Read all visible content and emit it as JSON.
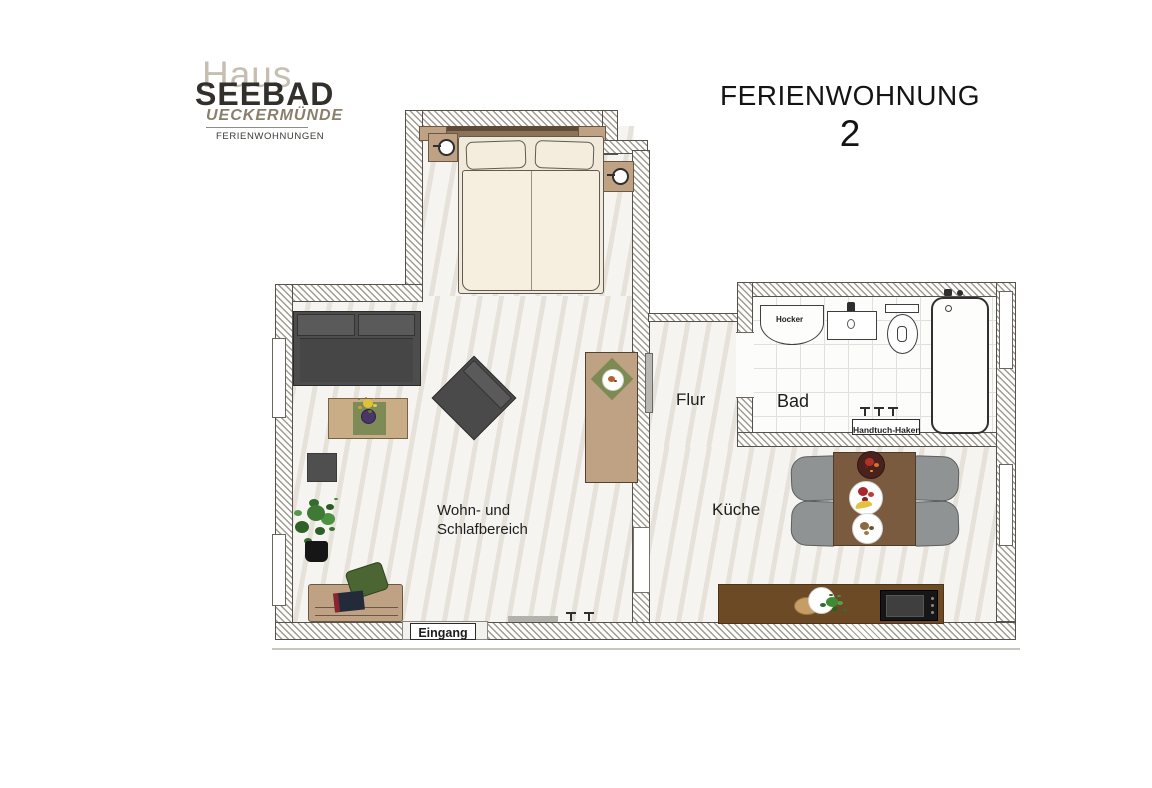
{
  "logo": {
    "line1": "Haus",
    "line2": "SEEBAD",
    "line3": "UECKERMÜNDE",
    "line4": "FERIENWOHNUNGEN"
  },
  "title": {
    "main": "FERIENWOHNUNG",
    "number": "2"
  },
  "rooms": {
    "living": {
      "line1": "Wohn- und",
      "line2": "Schlafbereich"
    },
    "hall": {
      "label": "Flur"
    },
    "bath": {
      "label": "Bad"
    },
    "kitchen": {
      "label": "Küche"
    },
    "entrance": {
      "label": "Eingang"
    }
  },
  "bath_items": {
    "stool_label": "Hocker",
    "towel_hooks_label": "Handtuch-Haken"
  },
  "palette": {
    "wall_line": "#56524b",
    "hatch": "#a19c93",
    "floor": "#edeae3",
    "bath_floor": "#fcfcfb",
    "tile_line": "#e2e0db",
    "bed": "#f6efe0",
    "outline": "#5f5a52",
    "wood": "#bfa184",
    "wood_dark": "#6a5845",
    "sofa": "#4d4d4d",
    "counter": "#6d4a26",
    "table_wood": "#7b5b3f",
    "chair": "#8f9394",
    "logo_gray": "#c6beb1",
    "logo_dark": "#33302b",
    "logo_brown": "#8a7f6c",
    "text": "#1c1c1c"
  }
}
